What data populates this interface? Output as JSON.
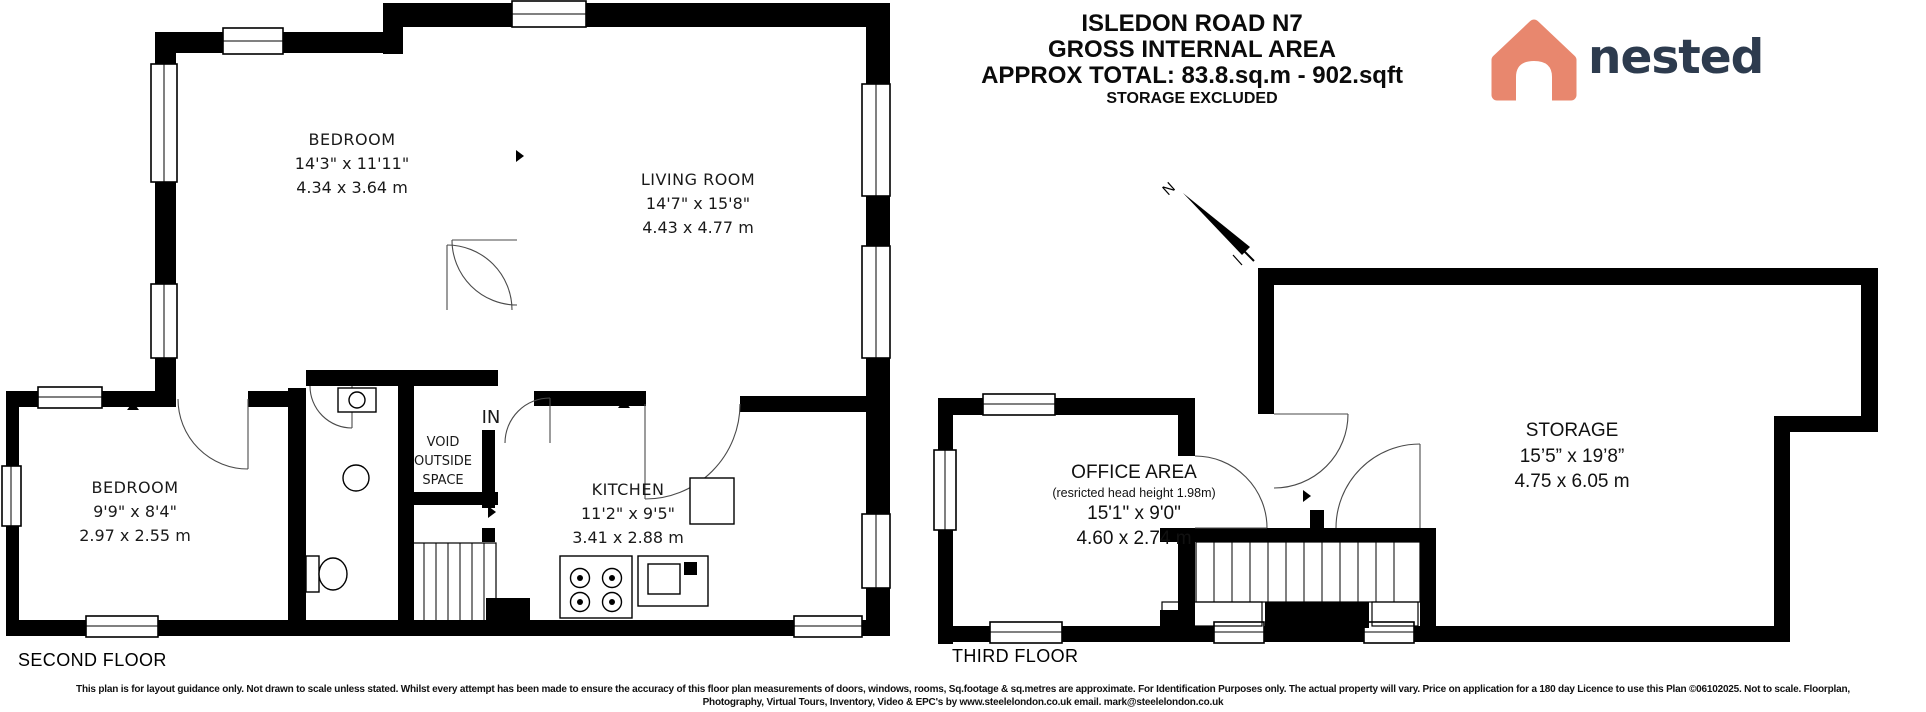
{
  "title_block": {
    "line1": "ISLEDON ROAD N7",
    "line2": "GROSS INTERNAL AREA",
    "line3": "APPROX TOTAL: 83.8.sq.m - 902.sqft",
    "line4": "STORAGE EXCLUDED"
  },
  "logo": {
    "text": "nested",
    "house_color": "#E8876E",
    "text_color": "#2D3B4E"
  },
  "compass": {
    "label": "N"
  },
  "colors": {
    "walls": "#000000",
    "background": "#ffffff"
  },
  "floors": {
    "second": {
      "label": "SECOND FLOOR",
      "rooms": [
        {
          "name": "BEDROOM",
          "imperial": "14'3\" x 11'11\"",
          "metric": "4.34 x 3.64 m"
        },
        {
          "name": "LIVING ROOM",
          "imperial": "14'7\" x 15'8\"",
          "metric": "4.43 x 4.77 m"
        },
        {
          "name": "BEDROOM",
          "imperial": "9'9\" x 8'4\"",
          "metric": "2.97 x 2.55 m"
        },
        {
          "name": "KITCHEN",
          "imperial": "11'2\" x 9'5\"",
          "metric": "3.41 x 2.88 m"
        }
      ],
      "void_label_lines": [
        "VOID",
        "OUTSIDE",
        "SPACE"
      ],
      "entrance_label": "IN"
    },
    "third": {
      "label": "THIRD FLOOR",
      "rooms": [
        {
          "name": "OFFICE AREA",
          "note": "(resricted head height 1.98m)",
          "imperial": "15'1\" x 9'0\"",
          "metric": "4.60 x 2.74 m"
        },
        {
          "name": "STORAGE",
          "imperial": "15’5” x 19’8”",
          "metric": "4.75 x 6.05 m"
        }
      ]
    }
  },
  "disclaimer": {
    "line1": "This plan is for layout guidance only. Not drawn to scale unless stated. Whilst every attempt has been made to ensure the accuracy of this floor plan measurements of doors, windows, rooms, Sq.footage & sq.metres are approximate. For Identification Purposes only. The actual property will vary. Price on application for a 180 day Licence to use this Plan ©06102025. Not to scale. Floorplan,",
    "line2": "Photography, Virtual Tours, Inventory, Video & EPC's by www.steelelondon.co.uk  email. mark@steelelondon.co.uk"
  }
}
